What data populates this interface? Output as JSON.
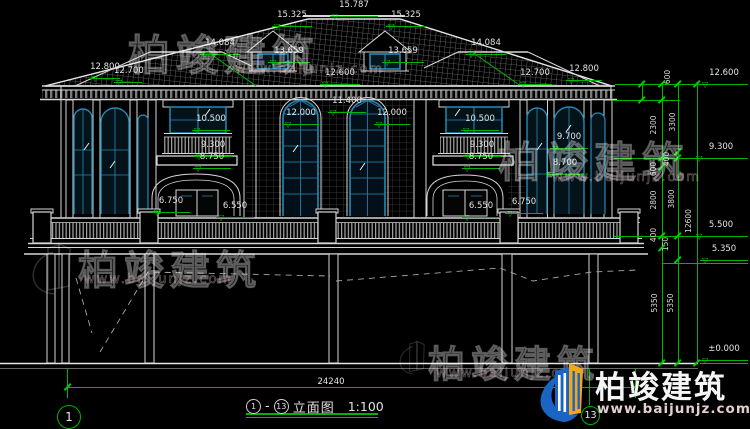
{
  "drawing": {
    "title_text": "立面图",
    "scale_label": "1:100",
    "dash": "-",
    "axis_left": "1",
    "axis_right": "13",
    "overall_width_dim": "24240"
  },
  "levels": {
    "ridge": "15.787",
    "ridge_end": "15.325",
    "wing_ridge": "14.084",
    "dormer": "13.659",
    "eave_hi": "12.800",
    "eave_lo": "12.700",
    "eave_base": "12.600",
    "arch_spring": "11.400",
    "window_top": "12.000",
    "f2_window": "10.500",
    "f2_rail": "9.300",
    "f2_floor": "8.750",
    "tower_rail_hi": "9.700",
    "tower_rail_lo": "8.700",
    "terrace_post": "6.750",
    "terrace_rail": "6.550",
    "deck": "5.500",
    "deck_lo": "5.350",
    "ground": "±0.000"
  },
  "vchain": {
    "d600": "600",
    "d2300": "2300",
    "d3300": "3300",
    "d400": "400",
    "d2800": "2800",
    "d3800": "3800",
    "d12600": "12600",
    "d150": "150",
    "d5350": "5350"
  },
  "watermark": {
    "brand": "柏竣建筑",
    "site": "www.baijunjz.com"
  },
  "logo": {
    "brand": "柏竣建筑",
    "site": "www.baijunjz.com"
  }
}
